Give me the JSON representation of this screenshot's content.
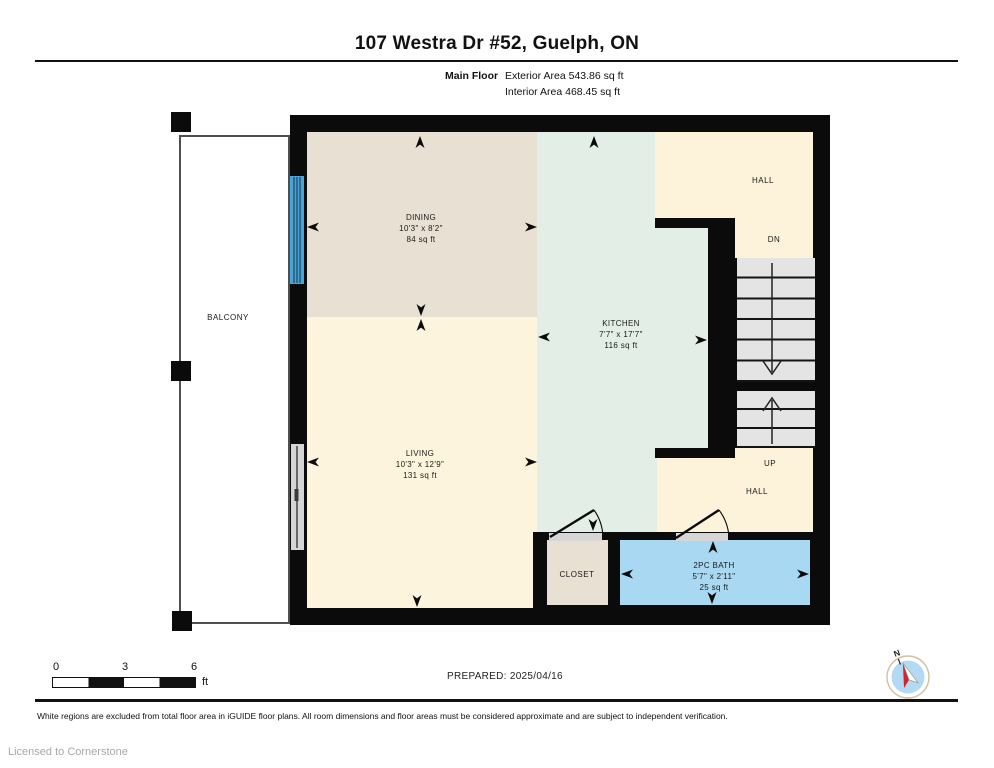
{
  "header": {
    "title": "107 Westra Dr #52, Guelph, ON",
    "floor_label": "Main Floor",
    "exterior_area": "Exterior Area 543.86 sq ft",
    "interior_area": "Interior Area 468.45 sq ft"
  },
  "rooms": {
    "dining": {
      "name": "DINING",
      "dims": "10'3\" x 8'2\"",
      "area": "84 sq ft"
    },
    "kitchen": {
      "name": "KITCHEN",
      "dims": "7'7\" x 17'7\"",
      "area": "116 sq ft"
    },
    "living": {
      "name": "LIVING",
      "dims": "10'3\" x 12'9\"",
      "area": "131 sq ft"
    },
    "bath": {
      "name": "2PC BATH",
      "dims": "5'7\" x 2'11\"",
      "area": "25 sq ft"
    },
    "closet": {
      "name": "CLOSET"
    },
    "balcony": {
      "name": "BALCONY"
    },
    "hall_upper": {
      "name": "HALL"
    },
    "hall_lower": {
      "name": "HALL"
    },
    "stairs_down": {
      "label": "DN"
    },
    "stairs_up": {
      "label": "UP"
    }
  },
  "scale_bar": {
    "tick_0": "0",
    "tick_3": "3",
    "tick_6": "6",
    "unit": "ft"
  },
  "compass": {
    "north_label": "N"
  },
  "footer": {
    "prepared": "PREPARED: 2025/04/16",
    "disclaimer": "White regions are excluded from total floor area in iGUIDE floor plans. All room dimensions and floor areas must be considered approximate and are subject to independent verification.",
    "license": "Licensed to Cornerstone"
  },
  "colors": {
    "wall": "#0b0b0b",
    "dining": "#e8e0d2",
    "living": "#fcf4dc",
    "kitchen": "#e3eee6",
    "hall": "#fcf3da",
    "bath": "#a9d8f2",
    "closet": "#e8e0d2",
    "stairs": "#e4e4e4",
    "window": "#d5d5d5",
    "slider_door": "#49a4da"
  }
}
